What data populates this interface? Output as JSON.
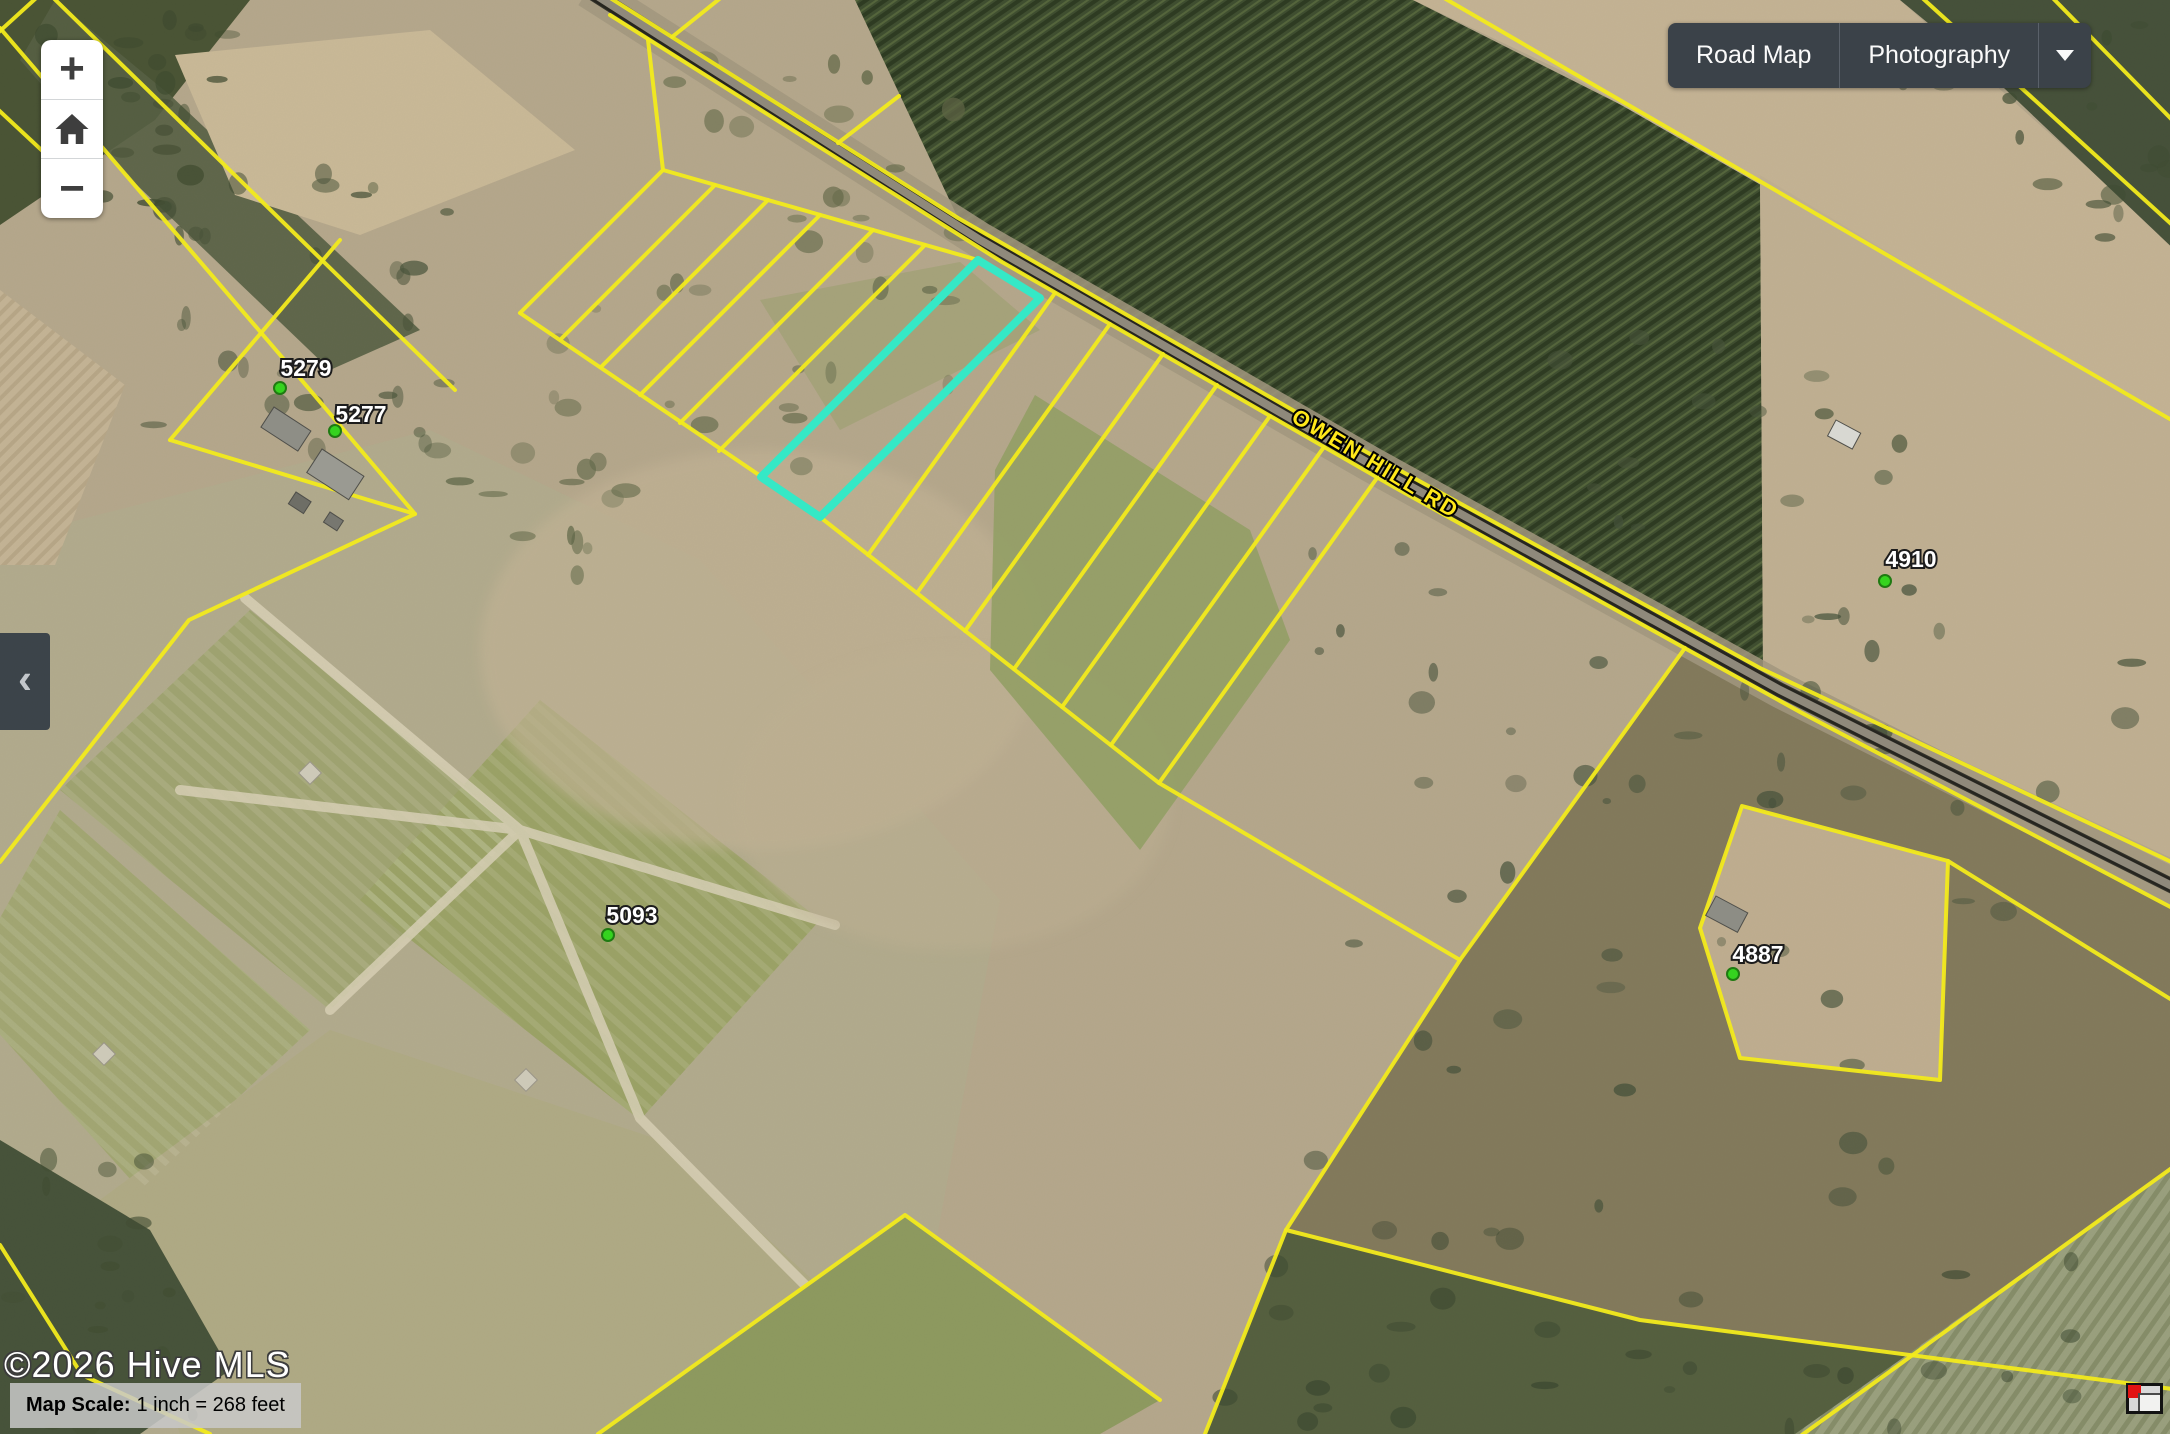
{
  "controls": {
    "zoom_in_label": "+",
    "zoom_out_label": "−",
    "home_icon": "home-icon",
    "collapse_chevron": "‹",
    "basemap": {
      "road_map_label": "Road Map",
      "photography_label": "Photography",
      "caret_icon": "chevron-down-icon"
    }
  },
  "attribution": {
    "text": "©2026 Hive MLS"
  },
  "scale": {
    "label": "Map Scale:",
    "value": "1 inch = 268 feet"
  },
  "map": {
    "road_label": {
      "text": "OWEN HILL RD",
      "x": 1372,
      "y": 470,
      "angle": 31,
      "color": "#ffe81a"
    },
    "parcel_line_color": "#f2ea1c",
    "highlight_color": "#35e8c6",
    "highlight_parcel": "978,260 1040,298 820,517 761,477",
    "road_path": "588,-10 980,240 1372,465 1780,690 2180,890",
    "parcel_labels": [
      {
        "text": "5279",
        "x": 306,
        "y": 368,
        "dot_x": 280,
        "dot_y": 388
      },
      {
        "text": "5277",
        "x": 361,
        "y": 414,
        "dot_x": 335,
        "dot_y": 431
      },
      {
        "text": "5093",
        "x": 632,
        "y": 915,
        "dot_x": 608,
        "dot_y": 935
      },
      {
        "text": "4910",
        "x": 1911,
        "y": 559,
        "dot_x": 1885,
        "dot_y": 581
      },
      {
        "text": "4887",
        "x": 1758,
        "y": 954,
        "dot_x": 1733,
        "dot_y": 974
      }
    ],
    "parcel_lines": [
      "566,-30 958,218 1350,443 1760,668 2180,866",
      "610,15 1002,262 1394,487 1800,712 2180,912",
      "663,170 978,260",
      "520,313 818,515",
      "663,170 520,313",
      "715,185 561,339",
      "768,200 601,367",
      "820,215 640,395",
      "873,230 680,423",
      "925,245 719,451",
      "820,517 1159,783 1460,960",
      "1055,293 868,555",
      "1110,324 917,593",
      "1163,354 965,631",
      "1217,385 1014,669",
      "1270,416 1062,707",
      "1324,447 1111,745",
      "1377,478 1159,783",
      "1685,648 1460,960 1286,1230 1205,1434",
      "1742,806 1948,861 1940,1080 1740,1058 1700,928 1742,806",
      "1948,861 2180,1005",
      "1286,1230 1640,1320 2180,1390",
      "1795,1440 2180,1162",
      "1413,-20 2180,425",
      "1908,-15 2180,232",
      "2040,-15 2180,128",
      "0,28 293,370 415,514",
      "35,-20 455,390",
      "340,240 170,440",
      "170,440 415,514",
      "415,514 189,620 0,862",
      "45,-10 -10,40",
      "-10,102 95,200",
      "648,40 663,170",
      "672,37 733,-12",
      "838,143 899,96",
      "598,1434 905,1215 1160,1400",
      "0,1245 82,1375 210,1434"
    ]
  }
}
